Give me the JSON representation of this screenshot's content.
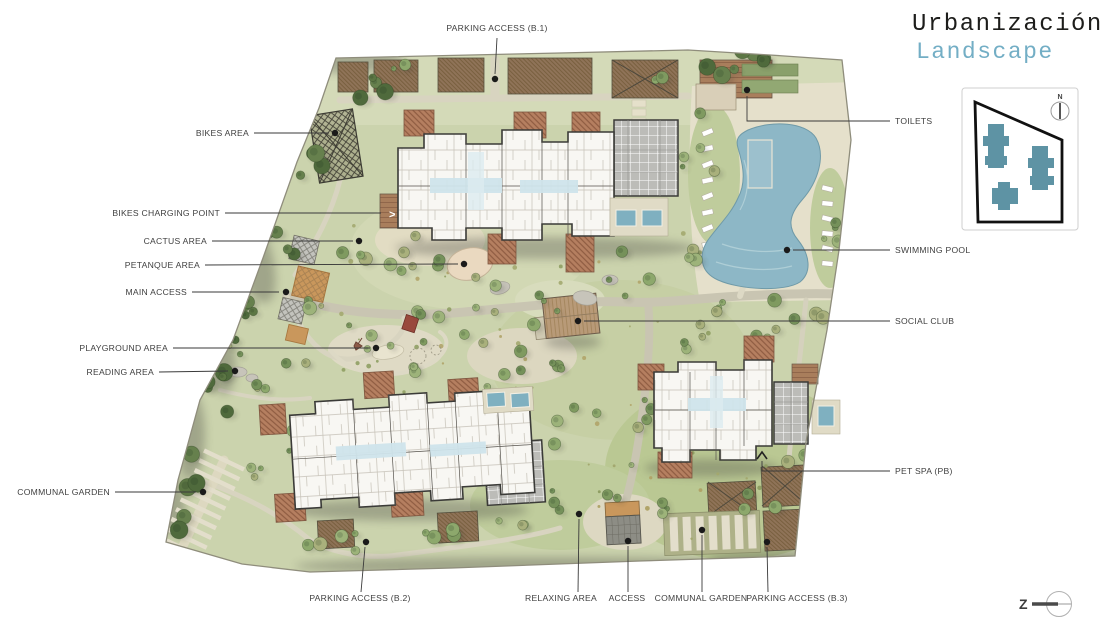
{
  "title": {
    "line1": "Urbanización",
    "line2": "Landscape",
    "accent_color": "#73aec5"
  },
  "keyplan": {
    "north_label": "N",
    "building_color": "#5e93a4"
  },
  "north_arrow": {
    "label": "Z"
  },
  "colors": {
    "grass": "#cbd3ad",
    "grass_light": "#d4dab8",
    "lawn": "#bfcc9c",
    "path": "#d8d4c0",
    "road": "#c9c5b2",
    "deck": "#e5e0cb",
    "pool": "#8db7c6",
    "building": "#f8f7f3",
    "outline": "#3b3b38",
    "pergola": "#b57f60",
    "soil": "#8f7358",
    "annex": "#bcbcb8",
    "access_orange": "#c9975c"
  },
  "plan": {
    "labels": [
      {
        "id": "parking-b1",
        "text": "PARKING ACCESS (B.1)",
        "anchor": "middle",
        "tx": 497,
        "ty": 31,
        "points": [
          [
            497,
            38
          ],
          [
            495,
            74
          ]
        ],
        "dot": [
          495,
          79
        ]
      },
      {
        "id": "bikes-area",
        "text": "BIKES AREA",
        "anchor": "end",
        "tx": 249,
        "ty": 136,
        "points": [
          [
            254,
            133
          ],
          [
            329,
            133
          ]
        ],
        "dot": [
          335,
          133
        ]
      },
      {
        "id": "bikes-charging-point",
        "text": "BIKES CHARGING POINT",
        "anchor": "end",
        "tx": 220,
        "ty": 216,
        "points": [
          [
            225,
            213
          ],
          [
            381,
            213
          ]
        ],
        "dot": null
      },
      {
        "id": "cactus-area",
        "text": "CACTUS AREA",
        "anchor": "end",
        "tx": 207,
        "ty": 244,
        "points": [
          [
            212,
            241
          ],
          [
            353,
            241
          ]
        ],
        "dot": [
          359,
          241
        ]
      },
      {
        "id": "petanque-area",
        "text": "PETANQUE AREA",
        "anchor": "end",
        "tx": 200,
        "ty": 268,
        "points": [
          [
            205,
            265
          ],
          [
            458,
            264
          ]
        ],
        "dot": [
          464,
          264
        ]
      },
      {
        "id": "main-access",
        "text": "MAIN ACCESS",
        "anchor": "end",
        "tx": 187,
        "ty": 295,
        "points": [
          [
            192,
            292
          ],
          [
            279,
            292
          ]
        ],
        "dot": [
          286,
          292
        ]
      },
      {
        "id": "playground-area",
        "text": "PLAYGROUND AREA",
        "anchor": "end",
        "tx": 168,
        "ty": 351,
        "points": [
          [
            173,
            348
          ],
          [
            370,
            348
          ]
        ],
        "dot": [
          376,
          348
        ]
      },
      {
        "id": "reading-area",
        "text": "READING AREA",
        "anchor": "end",
        "tx": 154,
        "ty": 375,
        "points": [
          [
            159,
            372
          ],
          [
            228,
            371
          ]
        ],
        "dot": [
          235,
          371
        ]
      },
      {
        "id": "communal-garden-left",
        "text": "COMMUNAL GARDEN",
        "anchor": "end",
        "tx": 110,
        "ty": 495,
        "points": [
          [
            115,
            492
          ],
          [
            196,
            492
          ]
        ],
        "dot": [
          203,
          492
        ]
      },
      {
        "id": "toilets",
        "text": "TOILETS",
        "anchor": "start",
        "tx": 895,
        "ty": 124,
        "points": [
          [
            890,
            121
          ],
          [
            747,
            121
          ],
          [
            747,
            96
          ]
        ],
        "dot": [
          747,
          90
        ]
      },
      {
        "id": "swimming-pool",
        "text": "SWIMMING POOL",
        "anchor": "start",
        "tx": 895,
        "ty": 253,
        "points": [
          [
            890,
            250
          ],
          [
            793,
            250
          ]
        ],
        "dot": [
          787,
          250
        ]
      },
      {
        "id": "social-club",
        "text": "SOCIAL CLUB",
        "anchor": "start",
        "tx": 895,
        "ty": 324,
        "points": [
          [
            890,
            321
          ],
          [
            584,
            321
          ]
        ],
        "dot": [
          578,
          321
        ]
      },
      {
        "id": "pet-spa",
        "text": "PET SPA (PB)",
        "anchor": "start",
        "tx": 895,
        "ty": 474,
        "points": [
          [
            890,
            471
          ],
          [
            762,
            471
          ],
          [
            762,
            461
          ]
        ],
        "dot": null,
        "marker": "chevron-up",
        "mx": 762,
        "my": 455
      },
      {
        "id": "parking-b2",
        "text": "PARKING ACCESS (B.2)",
        "anchor": "middle",
        "tx": 360,
        "ty": 601,
        "points": [
          [
            361,
            592
          ],
          [
            365,
            547
          ]
        ],
        "dot": [
          366,
          542
        ]
      },
      {
        "id": "relaxing-area",
        "text": "RELAXING AREA",
        "anchor": "middle",
        "tx": 561,
        "ty": 601,
        "points": [
          [
            578,
            592
          ],
          [
            579,
            519
          ]
        ],
        "dot": [
          579,
          514
        ]
      },
      {
        "id": "access",
        "text": "ACCESS",
        "anchor": "middle",
        "tx": 627,
        "ty": 601,
        "points": [
          [
            628,
            592
          ],
          [
            628,
            546
          ]
        ],
        "dot": [
          628,
          541
        ]
      },
      {
        "id": "communal-garden-bottom",
        "text": "COMMUNAL GARDEN",
        "anchor": "middle",
        "tx": 701,
        "ty": 601,
        "points": [
          [
            702,
            592
          ],
          [
            702,
            535
          ]
        ],
        "dot": [
          702,
          530
        ]
      },
      {
        "id": "parking-b3",
        "text": "PARKING ACCESS (B.3)",
        "anchor": "middle",
        "tx": 797,
        "ty": 601,
        "points": [
          [
            768,
            592
          ],
          [
            767,
            547
          ]
        ],
        "dot": [
          767,
          542
        ]
      }
    ]
  }
}
